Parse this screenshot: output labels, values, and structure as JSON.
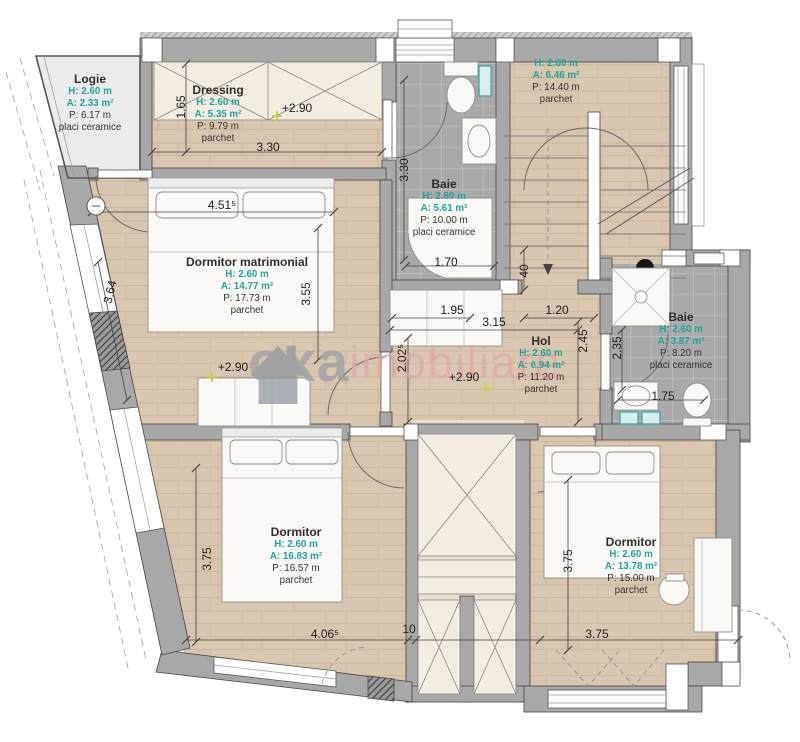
{
  "brand": {
    "gray": "oxa",
    "pink": "imobiliare"
  },
  "colors": {
    "teal_accent": "#1fa39e",
    "watermark_gray": "#979ea8",
    "watermark_pink": "#e3a6a6",
    "wall_gray": "#a8a8a8",
    "wood_floor": "#d9c6ae",
    "tile_floor": "#a9a9a9",
    "level_marker_yellow": "#c9cf4e"
  },
  "rooms": [
    {
      "name": "Logie",
      "h": "H: 2.60 m",
      "a": "A: 2.33 m²",
      "p": "P: 6.17 m",
      "f": "placi ceramice"
    },
    {
      "name": "Dressing",
      "h": "H: 2.60 m",
      "a": "A: 5.35 m²",
      "p": "P: 9.79 m",
      "f": "parchet"
    },
    {
      "name": "Baie",
      "h": "H: 2.60 m",
      "a": "A: 5.61 m²",
      "p": "P: 10.00 m",
      "f": "placi ceramice"
    },
    {
      "name": "",
      "h": "H: 2.60 m",
      "a": "A: 6.46 m²",
      "p": "P: 14.40 m",
      "f": "parchet"
    },
    {
      "name": "Dormitor matrimonial",
      "h": "H: 2.60 m",
      "a": "A: 14.77 m²",
      "p": "P: 17.73 m",
      "f": "parchet"
    },
    {
      "name": "Hol",
      "h": "H: 2.60 m",
      "a": "A: 6.94 m²",
      "p": "P: 11.20 m",
      "f": "parchet"
    },
    {
      "name": "Baie",
      "h": "H: 2.60 m",
      "a": "A: 3.87 m²",
      "p": "P: 8.20 m",
      "f": "placi ceramice"
    },
    {
      "name": "Dormitor",
      "h": "H: 2.60 m",
      "a": "A: 16.83 m²",
      "p": "P: 16.57 m",
      "f": "parchet"
    },
    {
      "name": "Dormitor",
      "h": "H: 2.60 m",
      "a": "A: 13.78 m²",
      "p": "P: 15.00 m",
      "f": "parchet"
    }
  ],
  "dims": [
    {
      "t": "1.65"
    },
    {
      "t": "3.30"
    },
    {
      "t": "+2.90"
    },
    {
      "t": "3.30"
    },
    {
      "t": "1.70"
    },
    {
      "t": "4.51⁵"
    },
    {
      "t": "3.55"
    },
    {
      "t": "3.64"
    },
    {
      "t": "+2.90"
    },
    {
      "t": "1.95"
    },
    {
      "t": "3.15"
    },
    {
      "t": "1.20"
    },
    {
      "t": "2.45"
    },
    {
      "t": "2.02⁵"
    },
    {
      "t": "+2.90"
    },
    {
      "t": "40"
    },
    {
      "t": "2.35"
    },
    {
      "t": "1.75"
    },
    {
      "t": "3.75"
    },
    {
      "t": "3.75"
    },
    {
      "t": "4.06⁵"
    },
    {
      "t": "10"
    },
    {
      "t": "3.75"
    }
  ]
}
